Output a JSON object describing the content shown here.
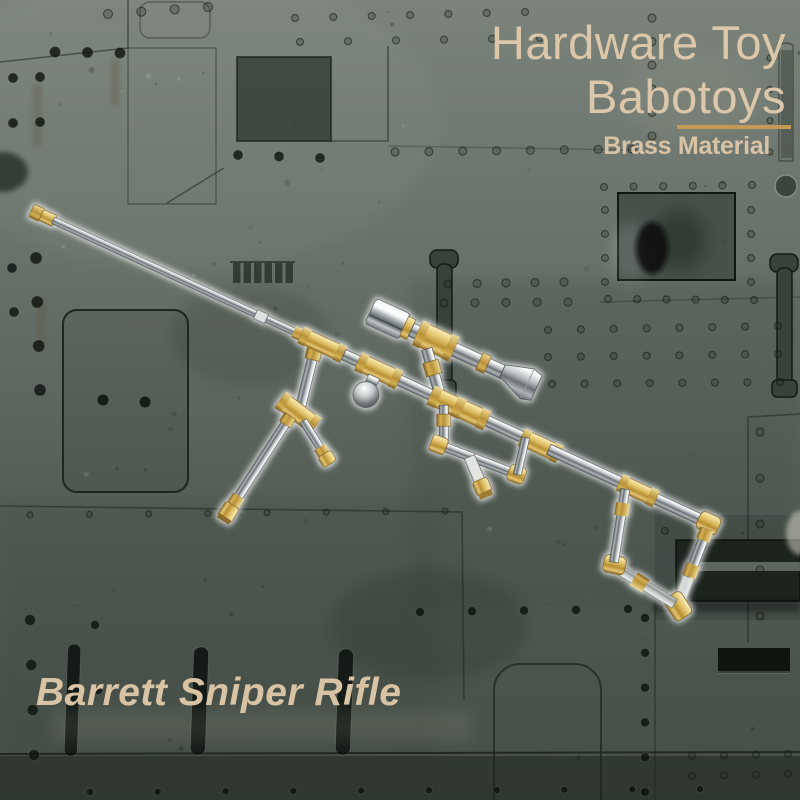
{
  "header": {
    "title_line1": "Hardware Toy",
    "title_line2": "Babotoys",
    "subtitle": "Brass Material",
    "text_color": "#dcc7ab",
    "subtitle_color": "#d9c3a5",
    "divider_color": "#c59a55"
  },
  "caption": {
    "product_name": "Barrett Sniper Rifle",
    "text_color": "#d8c3a4"
  },
  "illustration": {
    "subject": "toy Barrett sniper rifle assembled from brass pipe fittings and chrome pipes",
    "brass_color": "#d8b65a",
    "chrome_color": "#b5bbbd"
  },
  "background": {
    "style": "olive-green military metal panels with rivets and access hatches",
    "base_color": "#5c665e",
    "panel_line_color": "#1d2620"
  }
}
